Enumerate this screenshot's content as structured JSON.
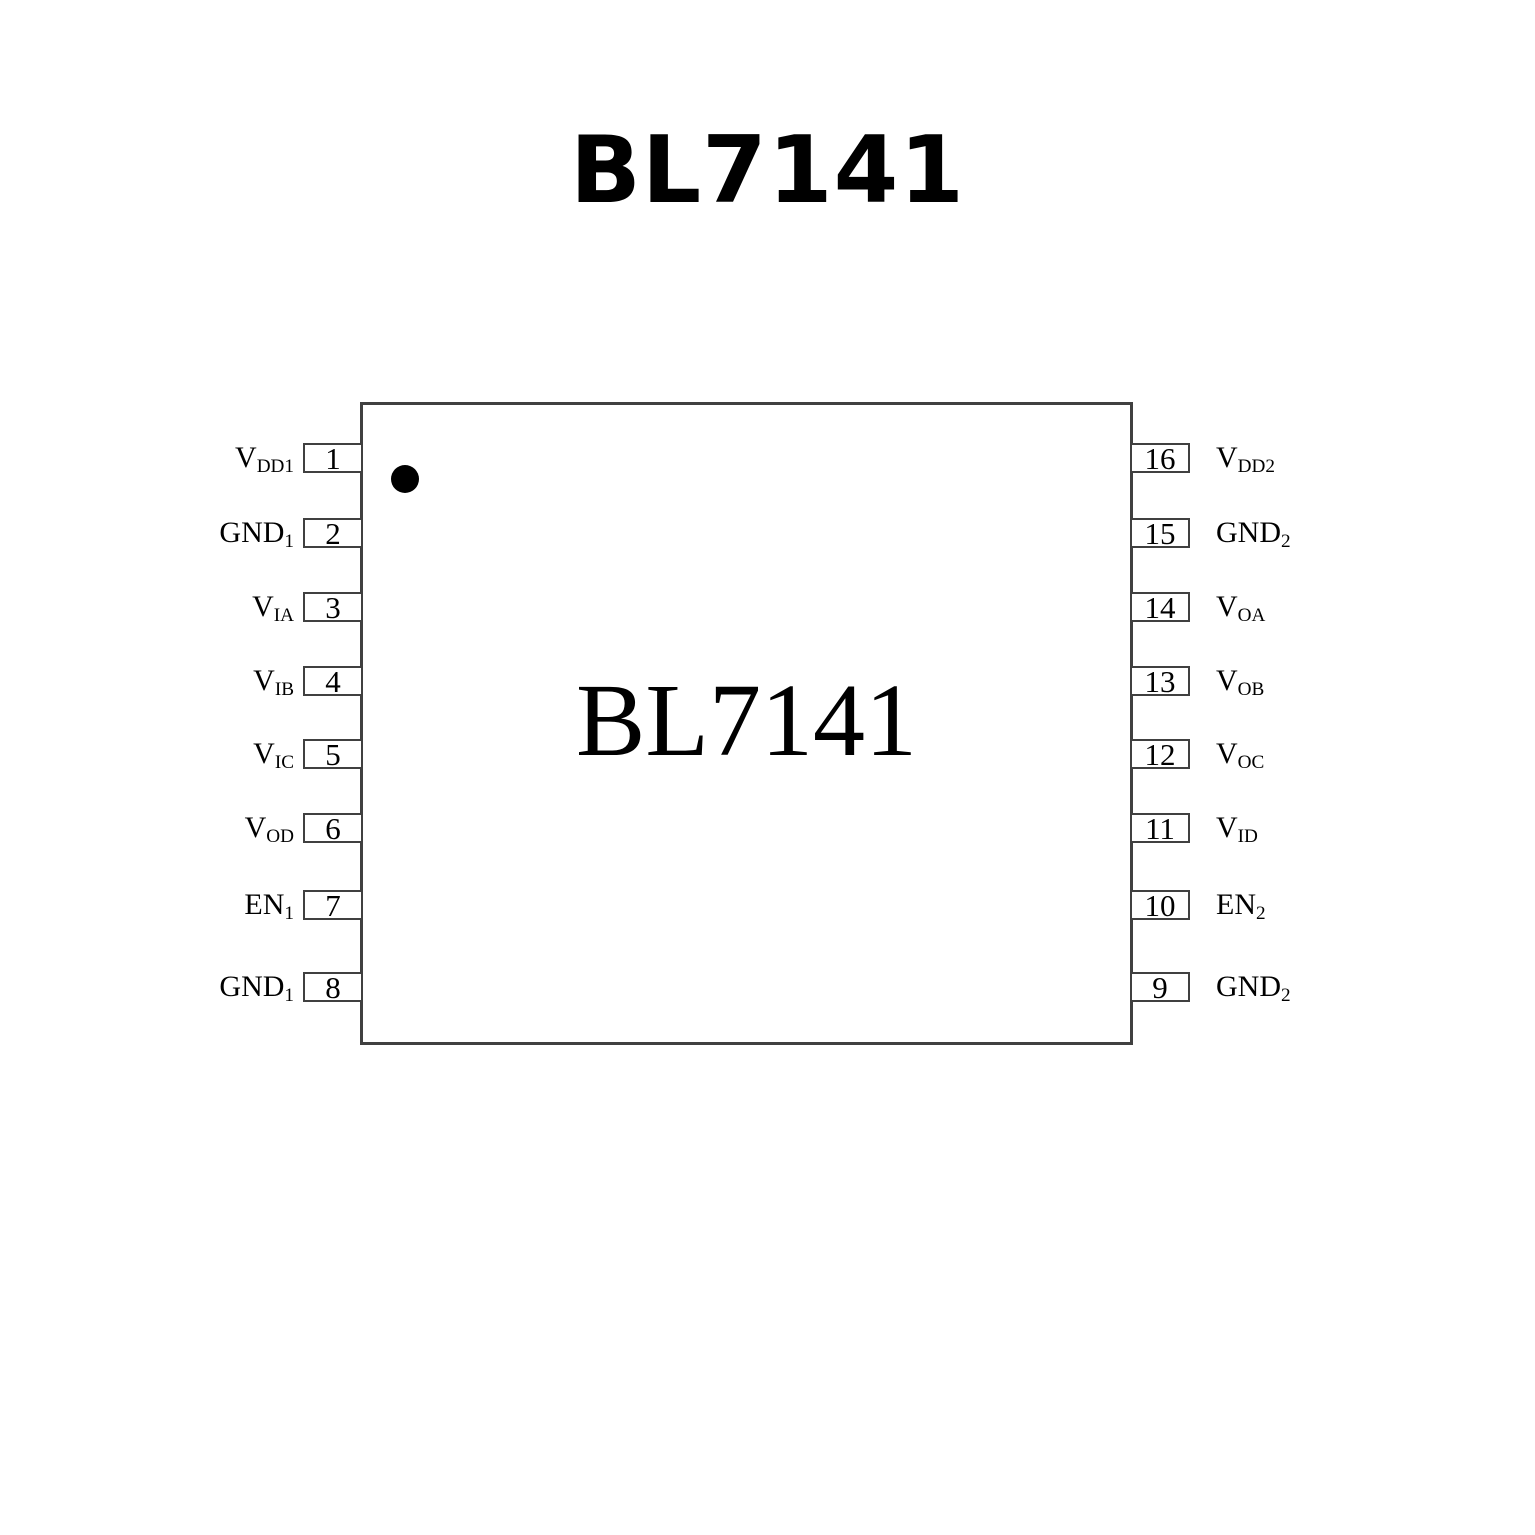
{
  "page_title": "BL7141",
  "chip": {
    "label": "BL7141"
  },
  "pins": {
    "left": [
      {
        "num": "1",
        "base": "V",
        "sub": "DD1"
      },
      {
        "num": "2",
        "base": "GND",
        "sub": "1"
      },
      {
        "num": "3",
        "base": "V",
        "sub": "IA"
      },
      {
        "num": "4",
        "base": "V",
        "sub": "IB"
      },
      {
        "num": "5",
        "base": "V",
        "sub": "IC"
      },
      {
        "num": "6",
        "base": "V",
        "sub": "OD"
      },
      {
        "num": "7",
        "base": "EN",
        "sub": "1"
      },
      {
        "num": "8",
        "base": "GND",
        "sub": "1"
      }
    ],
    "right": [
      {
        "num": "16",
        "base": "V",
        "sub": "DD2"
      },
      {
        "num": "15",
        "base": "GND",
        "sub": "2"
      },
      {
        "num": "14",
        "base": "V",
        "sub": "OA"
      },
      {
        "num": "13",
        "base": "V",
        "sub": "OB"
      },
      {
        "num": "12",
        "base": "V",
        "sub": "OC"
      },
      {
        "num": "11",
        "base": "V",
        "sub": "ID"
      },
      {
        "num": "10",
        "base": "EN",
        "sub": "2"
      },
      {
        "num": "9",
        "base": "GND",
        "sub": "2"
      }
    ]
  },
  "colors": {
    "line": "#404040",
    "text": "#000000",
    "background": "#ffffff",
    "pin1_marker": "#000000"
  }
}
